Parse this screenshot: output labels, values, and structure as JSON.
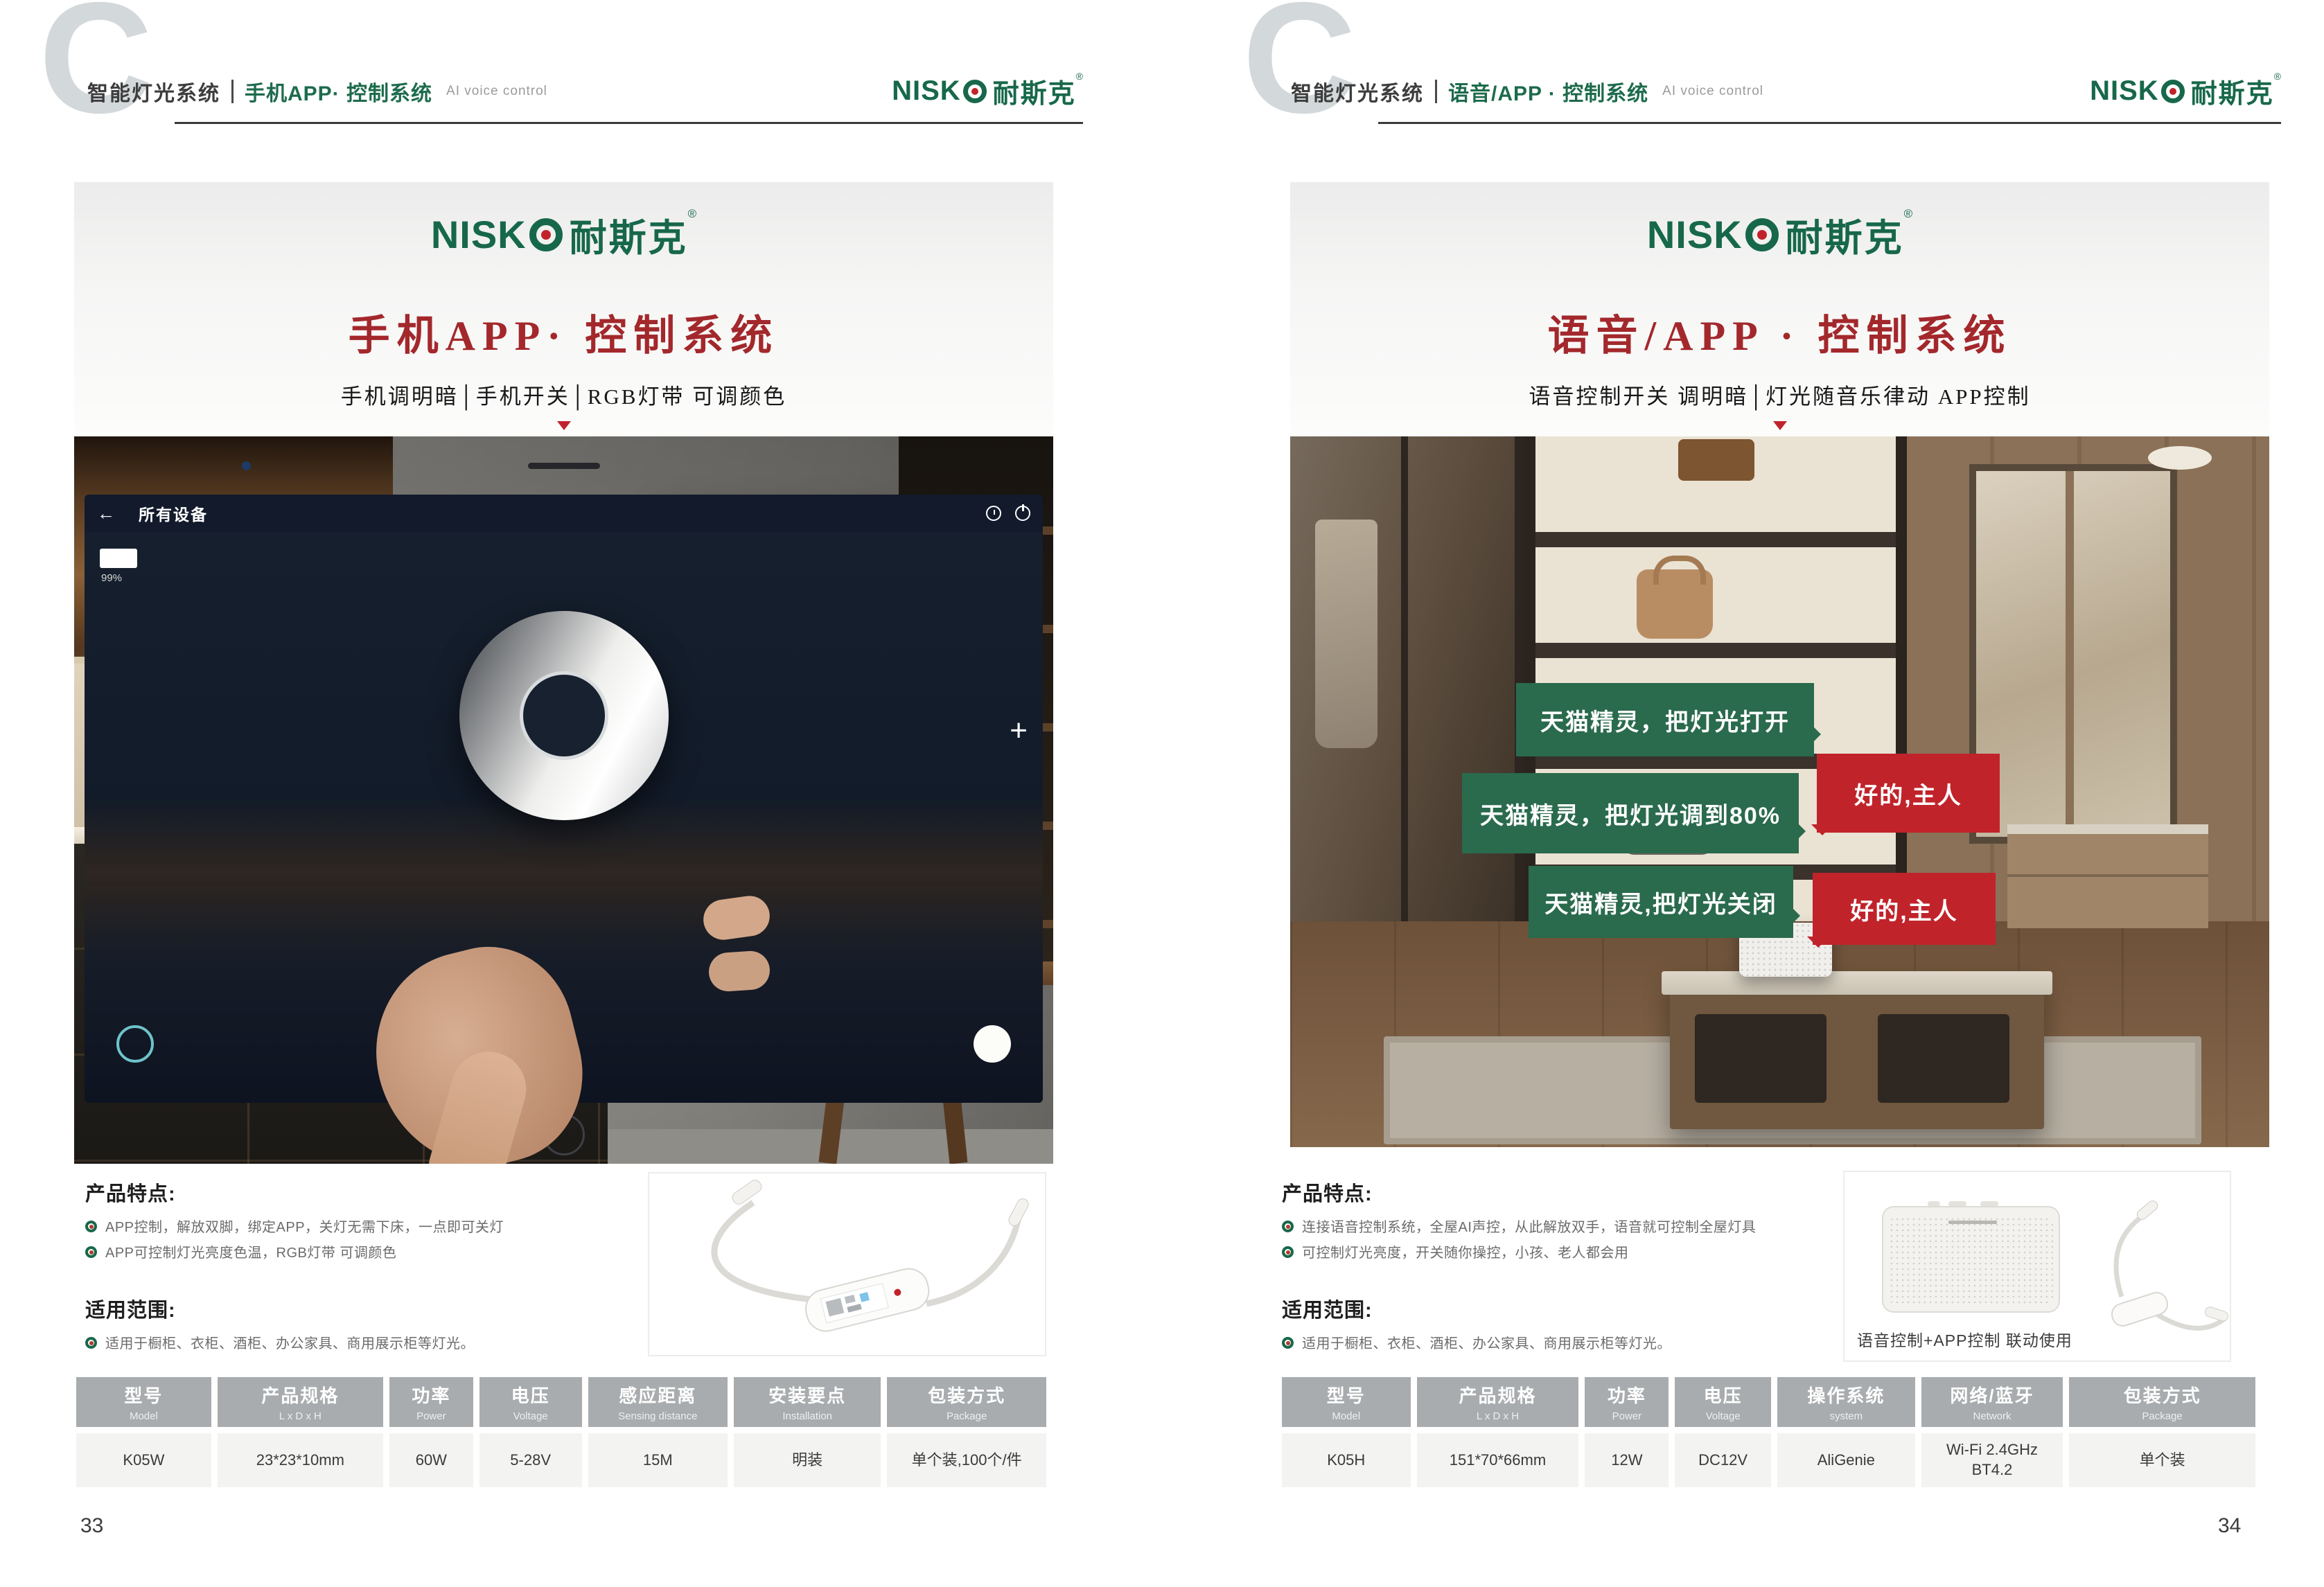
{
  "colors": {
    "brand_green": "#17684a",
    "title_red": "#a3282c",
    "bubble_green": "#2a6a4d",
    "bubble_red": "#c1232b"
  },
  "logo": {
    "latin": "NISK",
    "cjk": "耐斯克",
    "reg": "®"
  },
  "left_page": {
    "header": {
      "letter": "C",
      "section": "智能灯光系统",
      "topic": "手机APP· 控制系统",
      "tagline": "AI voice control"
    },
    "hero": {
      "title": "手机APP· 控制系统",
      "subtitle": "手机调明暗│手机开关│RGB灯带 可调颜色"
    },
    "phone": {
      "back_arrow": "←",
      "screen_title": "所有设备",
      "battery_percent": "99%",
      "plus": "+"
    },
    "features": {
      "title": "产品特点:",
      "items": [
        "APP控制，解放双脚，绑定APP，关灯无需下床，一点即可关灯",
        "APP可控制灯光亮度色温，RGB灯带 可调颜色"
      ]
    },
    "scope": {
      "title": "适用范围:",
      "items": [
        "适用于橱柜、衣柜、酒柜、办公家具、商用展示柜等灯光。"
      ]
    },
    "table": {
      "headers": [
        {
          "cn": "型号",
          "en": "Model"
        },
        {
          "cn": "产品规格",
          "en": "L x D x H"
        },
        {
          "cn": "功率",
          "en": "Power"
        },
        {
          "cn": "电压",
          "en": "Voltage"
        },
        {
          "cn": "感应距离",
          "en": "Sensing distance"
        },
        {
          "cn": "安装要点",
          "en": "Installation"
        },
        {
          "cn": "包装方式",
          "en": "Package"
        }
      ],
      "row": [
        "K05W",
        "23*23*10mm",
        "60W",
        "5-28V",
        "15M",
        "明装",
        "单个装,100个/件"
      ]
    },
    "page_number": "33"
  },
  "right_page": {
    "header": {
      "letter": "C",
      "section": "智能灯光系统",
      "topic": "语音/APP · 控制系统",
      "tagline": "AI voice control"
    },
    "hero": {
      "title": "语音/APP · 控制系统",
      "subtitle": "语音控制开关 调明暗│灯光随音乐律动 APP控制"
    },
    "bubbles": {
      "commands": [
        "天猫精灵，把灯光打开",
        "天猫精灵，把灯光调到80%",
        "天猫精灵,把灯光关闭"
      ],
      "replies": [
        "好的,主人",
        "好的,主人"
      ]
    },
    "product_caption": "语音控制+APP控制 联动使用",
    "features": {
      "title": "产品特点:",
      "items": [
        "连接语音控制系统，全屋AI声控，从此解放双手，语音就可控制全屋灯具",
        "可控制灯光亮度，开关随你操控，小孩、老人都会用"
      ]
    },
    "scope": {
      "title": "适用范围:",
      "items": [
        "适用于橱柜、衣柜、酒柜、办公家具、商用展示柜等灯光。"
      ]
    },
    "table": {
      "headers": [
        {
          "cn": "型号",
          "en": "Model"
        },
        {
          "cn": "产品规格",
          "en": "L x D x H"
        },
        {
          "cn": "功率",
          "en": "Power"
        },
        {
          "cn": "电压",
          "en": "Voltage"
        },
        {
          "cn": "操作系统",
          "en": "system"
        },
        {
          "cn": "网络/蓝牙",
          "en": "Network"
        },
        {
          "cn": "包装方式",
          "en": "Package"
        }
      ],
      "row": [
        "K05H",
        "151*70*66mm",
        "12W",
        "DC12V",
        "AliGenie",
        "Wi-Fi 2.4GHz\nBT4.2",
        "单个装"
      ]
    },
    "page_number": "34"
  }
}
